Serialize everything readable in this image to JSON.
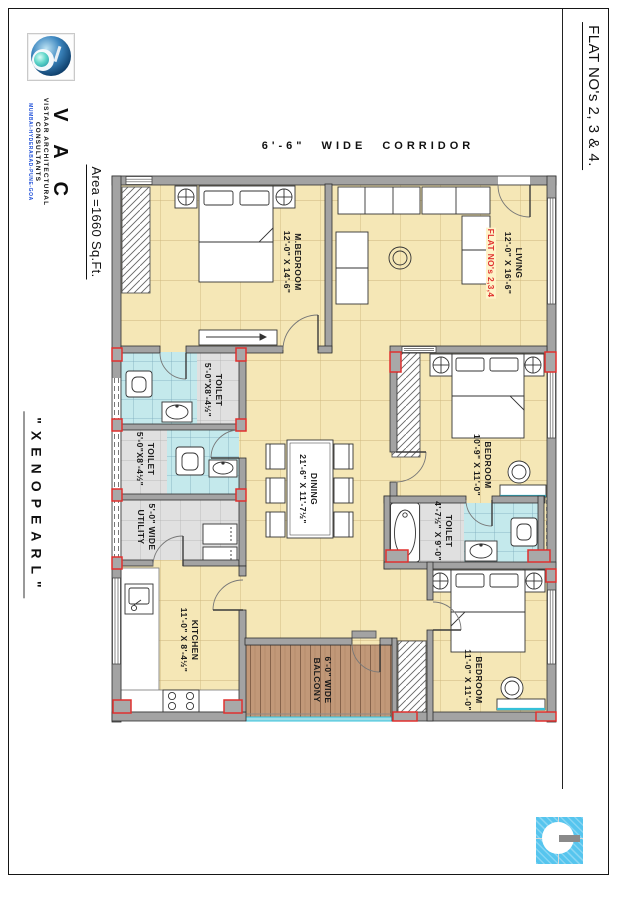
{
  "sheet": {
    "corridor_label": "6'-6\"  WIDE  CORRIDOR",
    "side_right_title": "FLAT NO's 2, 3 & 4.",
    "side_left_area": "Area =1660 Sq.Ft.",
    "side_left_project": "\"XENOPEARL\""
  },
  "brand": {
    "abbr": "V A C",
    "name_line1": "VISTAAR ARCHITECTURAL",
    "name_line2": "CONSULTANTS",
    "cities": "MUMBAI-HYDERABAD-PUNE-GOA"
  },
  "annotations": {
    "flat_numbers_note": "FLAT NO's 2,3,4"
  },
  "rooms": {
    "m_bedroom": {
      "name": "M.BEDROOM",
      "dims": "12'-0\" X 14'-6\""
    },
    "living": {
      "name": "LIVING",
      "dims": "12'-0\" X 16'-6\""
    },
    "toilet_1": {
      "name": "TOILET",
      "dims": "5'-0\"X8'-4½\""
    },
    "toilet_2": {
      "name": "TOILET",
      "dims": "5'-0\"X8'-4½\""
    },
    "utility": {
      "name": "5'-0\" WIDE",
      "dims": "UTILITY"
    },
    "dining": {
      "name": "DINING",
      "dims": "21'-6\" X 11'-7½\""
    },
    "bedroom_right": {
      "name": "BEDROOM",
      "dims": "10'-9\" X 11'-0\""
    },
    "toilet_right": {
      "name": "TOILET",
      "dims": "4'-7½\" X 9'-0\""
    },
    "kitchen": {
      "name": "KITCHEN",
      "dims": "11'-0\" X 8'-4½\""
    },
    "balcony": {
      "name": "6'-0\" WIDE",
      "dims": "BALCONY"
    },
    "bedroom_bottom": {
      "name": "BEDROOM",
      "dims": "11'-0\" X 11'-0\""
    }
  },
  "colors": {
    "floor_tile": "#F5E7B6",
    "tile_line": "#CDB67D",
    "toilet_tile": "#C4E9EC",
    "wall": "#A3A3A3",
    "accent_red": "#E0312F",
    "balcony_wood": "#C19878",
    "railing_blue": "#35C0D8",
    "logo_blue": "#56C5EE",
    "brand_blue": "#1D4ED8"
  }
}
